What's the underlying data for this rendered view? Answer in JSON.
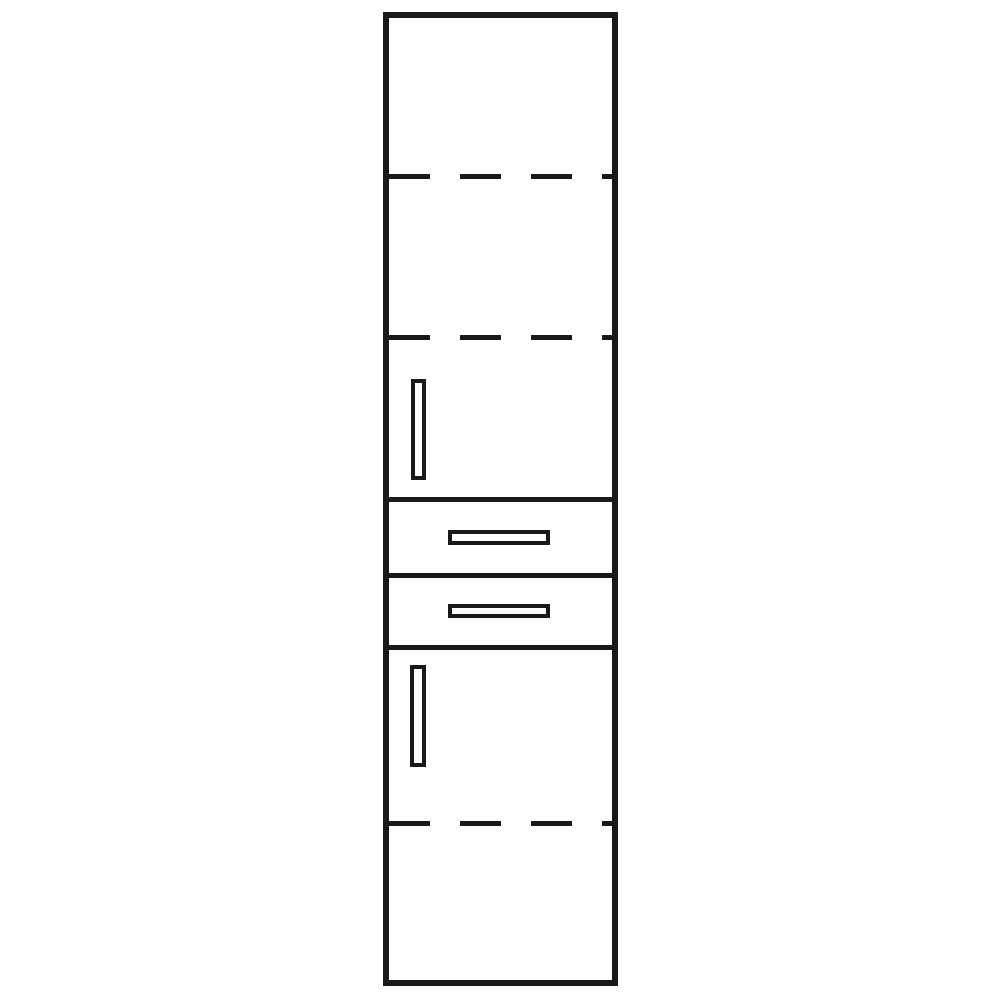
{
  "diagram": {
    "type": "furniture-schematic-line-drawing",
    "subject": "tall-cabinet-front-elevation",
    "colors": {
      "line": "#1a1a18",
      "background": "#ffffff",
      "fill": "#ffffff"
    },
    "line_style": {
      "outer_border_px": 6,
      "inner_line_px": 5,
      "handle_stroke_px": 4,
      "dash_length_px": 41,
      "dash_gap_px": 30
    },
    "components": {
      "cabinet_body": {
        "name": "cabinet-outline",
        "count": 1
      },
      "adjustable_shelves_dashed": {
        "count": 3,
        "items": [
          {
            "name": "shelf-line-1",
            "zone": "upper-door"
          },
          {
            "name": "shelf-line-2",
            "zone": "upper-door"
          },
          {
            "name": "shelf-line-3",
            "zone": "lower-door"
          }
        ]
      },
      "solid_dividers": {
        "count": 3,
        "items": [
          {
            "name": "divider-above-drawer-1"
          },
          {
            "name": "divider-between-drawers"
          },
          {
            "name": "divider-below-drawer-2"
          }
        ]
      },
      "doors": {
        "count": 2,
        "items": [
          {
            "name": "upper-door",
            "handle": "vertical-bar-handle-left"
          },
          {
            "name": "lower-door",
            "handle": "vertical-bar-handle-left"
          }
        ]
      },
      "drawers": {
        "count": 2,
        "items": [
          {
            "name": "drawer-1",
            "handle": "horizontal-bar-handle-center"
          },
          {
            "name": "drawer-2",
            "handle": "horizontal-bar-handle-center"
          }
        ]
      }
    }
  }
}
